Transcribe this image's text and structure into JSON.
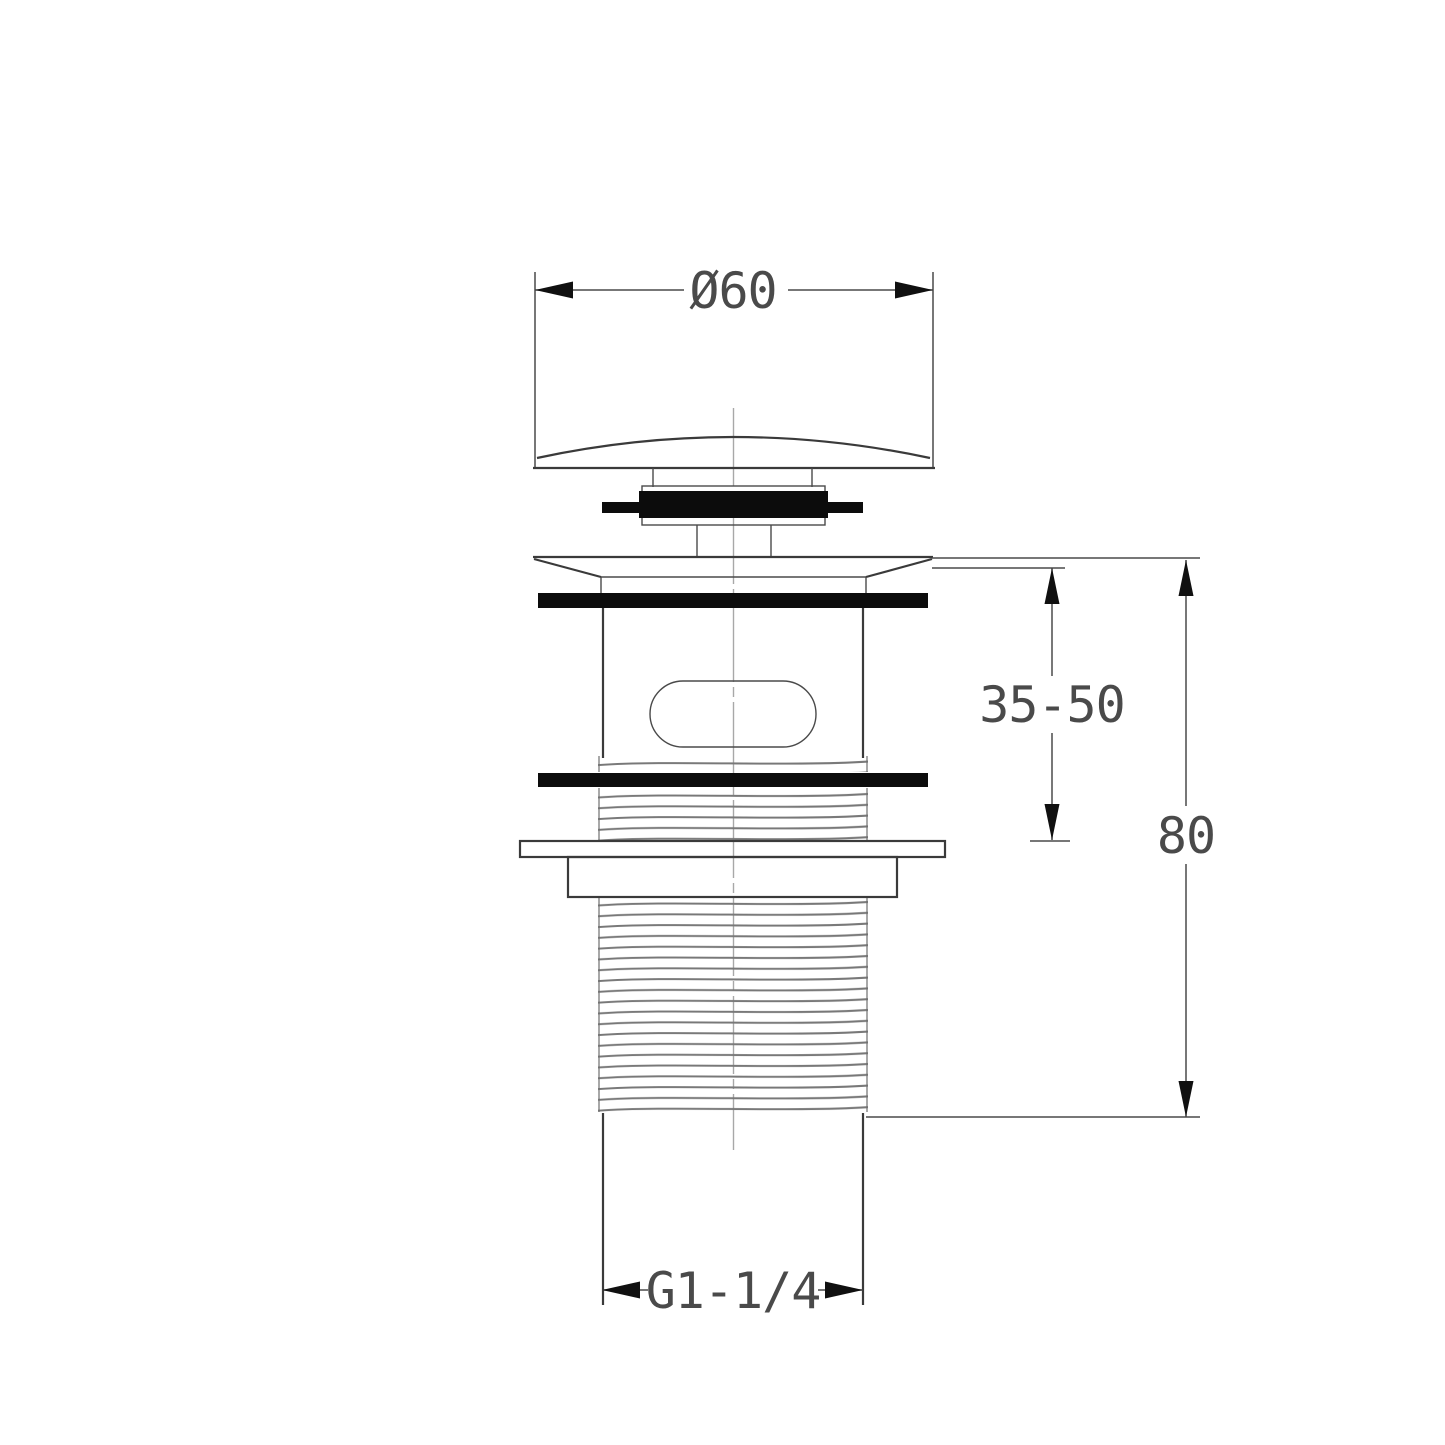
{
  "drawing": {
    "annotations": {
      "cap_diameter": "Ø60",
      "clamp_range": "35-50",
      "body_length": "80",
      "thread_spec": "G1-1/4"
    },
    "colors": {
      "background": "#ffffff",
      "outline": "#3a3a3a",
      "dimension_line": "#4a4a4a",
      "arrow_fill": "#101010",
      "gasket_fill": "#0c0c0c",
      "thread_line": "#787878",
      "centerline": "#a8a8a8"
    }
  }
}
